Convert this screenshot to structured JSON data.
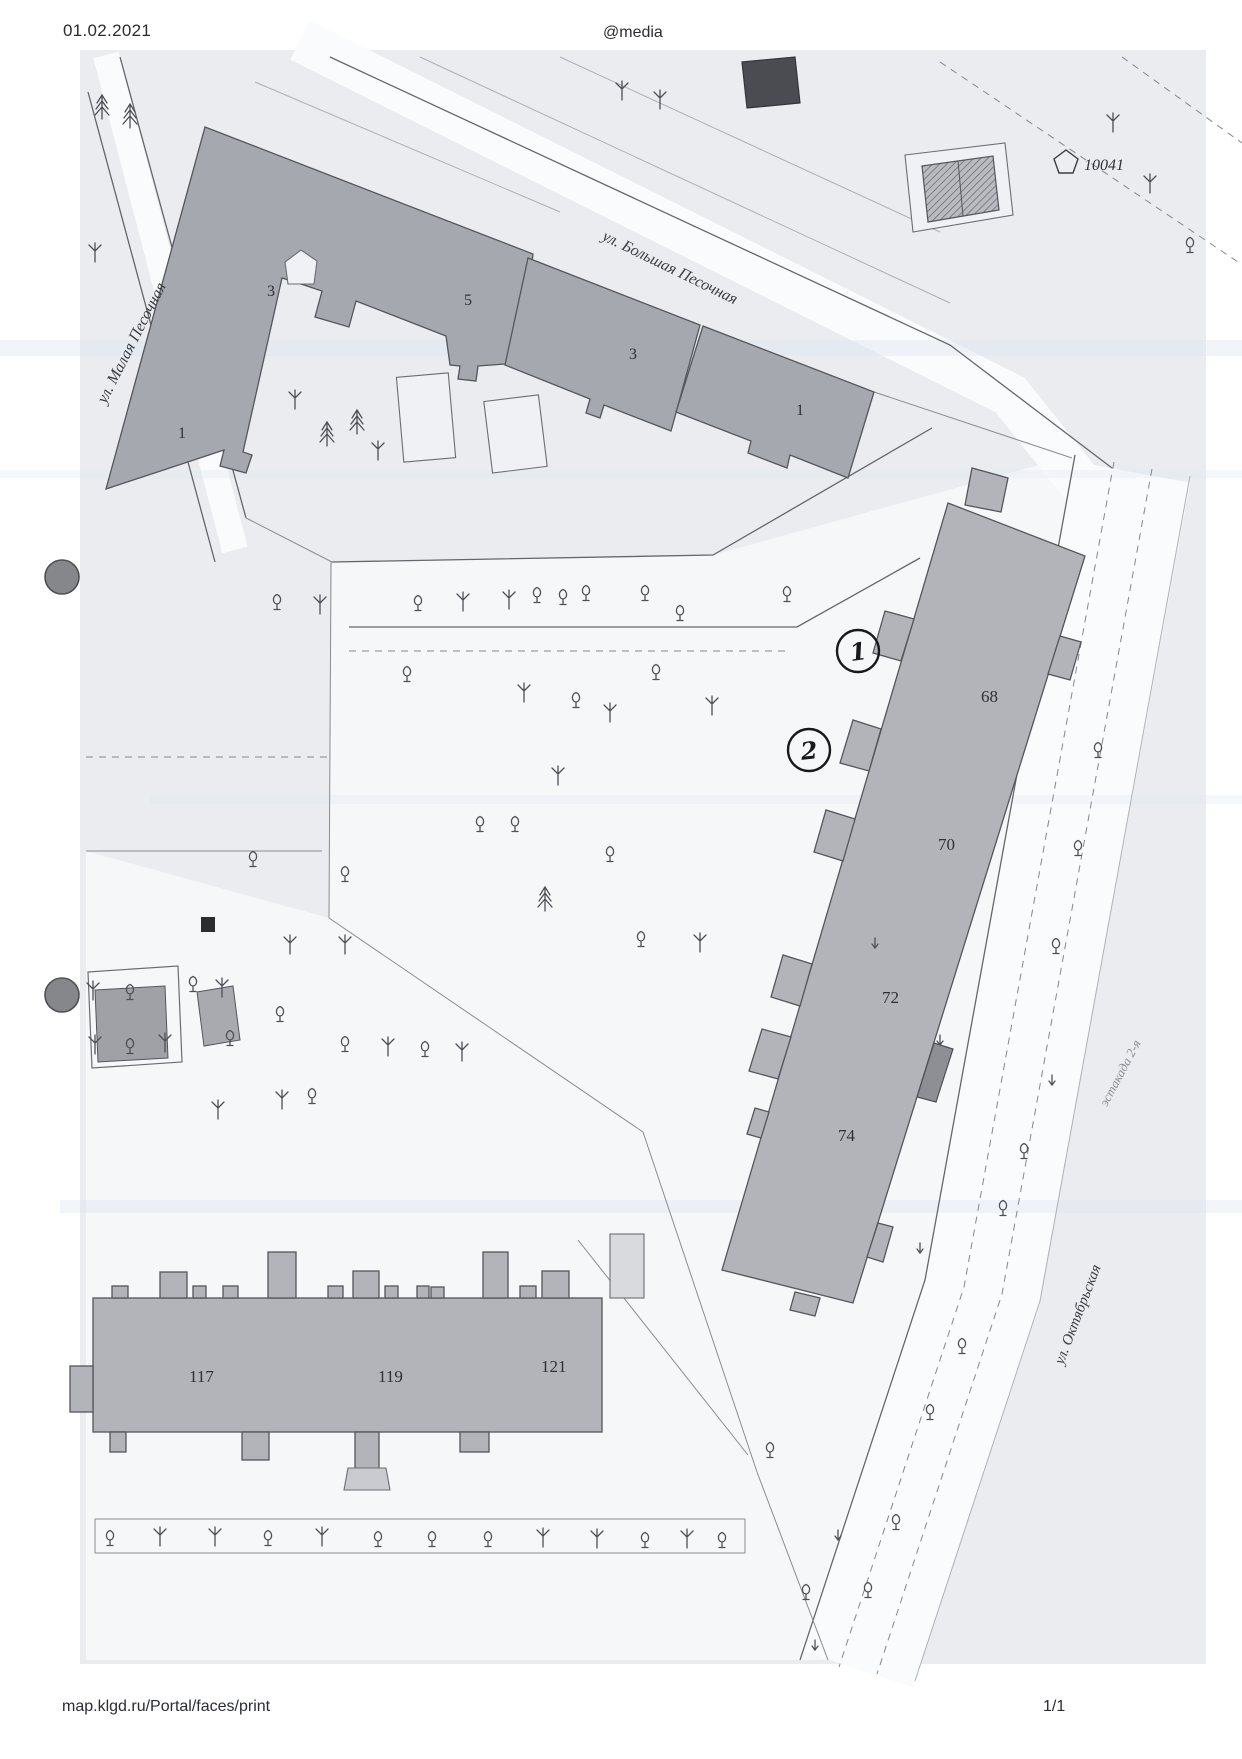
{
  "header": {
    "date": "01.02.2021",
    "center": "@media"
  },
  "footer": {
    "url": "map.klgd.ru/Portal/faces/print",
    "page": "1/1"
  },
  "map": {
    "streets": {
      "malaya": "ул. Малая Песочная",
      "bolshaya": "ул. Большая Песочная",
      "oktyabrskaya": "ул. Октябрьская",
      "estakada": "эстакада 2-я"
    },
    "landmark": "10041",
    "numbers": {
      "n3a": "3",
      "n5": "5",
      "n1a": "1",
      "n3b": "3",
      "n1b": "1",
      "n68": "68",
      "n70": "70",
      "n72": "72",
      "n74": "74",
      "n117": "117",
      "n119": "119",
      "n121": "121"
    },
    "annotations": {
      "a1": "1",
      "a2": "2"
    },
    "colors": {
      "building": "#a6a8af",
      "building_light": "#b2b4ba",
      "map_tint": "#eaecef",
      "line": "#54565c",
      "text": "#2e3036"
    }
  }
}
